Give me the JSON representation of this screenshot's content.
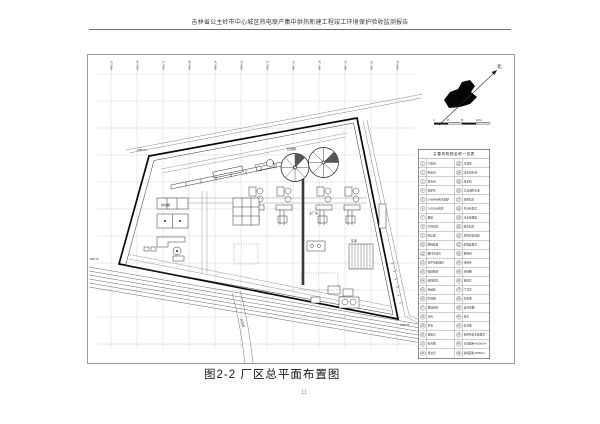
{
  "header": {
    "title": "吉林省公主岭市中心城区热电联产集中供热新建工程竣工环境保护验收监测报告"
  },
  "figure": {
    "caption": "图2-2 厂区总平面布置图",
    "north_label": "北",
    "scale_bar": {
      "ticks": [
        "0",
        "25",
        "50",
        "100m"
      ]
    },
    "grid_labels": [
      "4845.20",
      "4845.46",
      "4845.72",
      "4845.98",
      "4846.24",
      "4846.50",
      "4846.76",
      "4847.02",
      "4847.28",
      "4847.54",
      "4847.80",
      "4848.06"
    ],
    "annotations": {
      "corner_top_left": "1885.60",
      "corner_bottom_left": "1884.20",
      "corner_bottom_right": "1880.55",
      "road_name": "兴华街",
      "label_coal_yard": "贮煤场",
      "label_main_building": "主厂房",
      "label_ash_silo": "灰库",
      "label_office": "综合楼"
    },
    "legend": {
      "title": "主要构筑物名称一览表",
      "rows": [
        {
          "n1": "1",
          "name1": "汽机间",
          "n2": "23",
          "name2": "冷却塔"
        },
        {
          "n1": "2",
          "name1": "除氧间",
          "n2": "24",
          "name2": "凉水塔水池"
        },
        {
          "n1": "3",
          "name1": "煤仓间",
          "n2": "25",
          "name2": "净水站"
        },
        {
          "n1": "4",
          "name1": "锅炉房",
          "n2": "26",
          "name2": "工业消防水池"
        },
        {
          "n1": "5",
          "name1": "2×58MW热水锅炉",
          "n2": "27",
          "name2": "消防泵房"
        },
        {
          "n1": "6",
          "name1": "2×220t/h锅炉",
          "n2": "28",
          "name2": "生活水泵房"
        },
        {
          "n1": "7",
          "name1": "烟囱",
          "n2": "29",
          "name2": "污水处理站"
        },
        {
          "n1": "8",
          "name1": "引风机房",
          "n2": "30",
          "name2": "雨水泵房"
        },
        {
          "n1": "9",
          "name1": "除尘器",
          "n2": "31",
          "name2": "总降压变电站"
        },
        {
          "n1": "10",
          "name1": "脱硫装置",
          "n2": "32",
          "name2": "配电装置室"
        },
        {
          "n1": "11",
          "name1": "循环水泵房",
          "n2": "33",
          "name2": "检修间"
        },
        {
          "n1": "12",
          "name1": "化学水处理间",
          "n2": "34",
          "name2": "材料库"
        },
        {
          "n1": "13",
          "name1": "输煤栈桥",
          "n2": "35",
          "name2": "材料棚"
        },
        {
          "n1": "14",
          "name1": "碎煤机室",
          "n2": "36",
          "name2": "地磅房"
        },
        {
          "n1": "15",
          "name1": "转运站",
          "n2": "37",
          "name2": "门卫室"
        },
        {
          "n1": "16",
          "name1": "贮煤场",
          "n2": "38",
          "name2": "停车场"
        },
        {
          "n1": "17",
          "name1": "推煤机库",
          "n2": "39",
          "name2": "自行车棚"
        },
        {
          "n1": "18",
          "name1": "灰库",
          "n2": "40",
          "name2": "食堂"
        },
        {
          "n1": "19",
          "name1": "渣仓",
          "n2": "41",
          "name2": "宿舍楼"
        },
        {
          "n1": "20",
          "name1": "油泵房",
          "n2": "42",
          "name2": "锅炉补给水处理室"
        },
        {
          "n1": "21",
          "name1": "综合楼",
          "n2": "43",
          "name2": "占地面积=50000m²"
        },
        {
          "n1": "22",
          "name1": "传达室",
          "n2": "44",
          "name2": "建筑面积≈5000m²"
        }
      ]
    }
  },
  "page_number": "11"
}
